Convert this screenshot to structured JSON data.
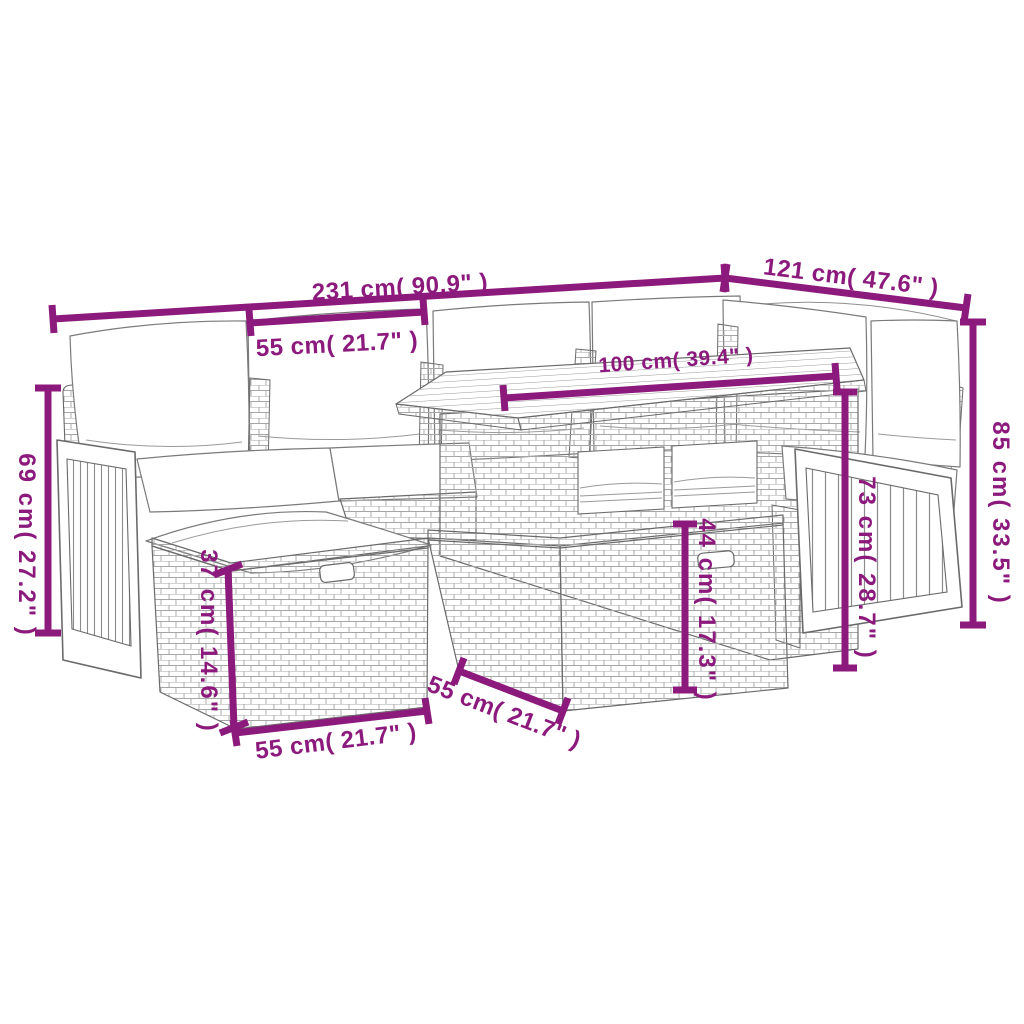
{
  "colors": {
    "dimension": "#8C1A7C",
    "line_art": "#6A6A6A",
    "texture": "#A6A6A6",
    "background": "#FFFFFF"
  },
  "diagram": {
    "type": "furniture-dimension-diagram",
    "subject": "poly rattan garden lounge set with cushions, ottomans and slatted-top table",
    "dimensions": [
      {
        "id": "total-width",
        "label": "231 cm( 90.9\" )",
        "cm": 231,
        "inch": 90.9,
        "orientation": "horizontal"
      },
      {
        "id": "right-side-depth",
        "label": "121 cm( 47.6\" )",
        "cm": 121,
        "inch": 47.6,
        "orientation": "horizontal-angled"
      },
      {
        "id": "seat-cushion-width",
        "label": "55 cm( 21.7\" )",
        "cm": 55,
        "inch": 21.7,
        "orientation": "horizontal"
      },
      {
        "id": "table-top-length",
        "label": "100 cm( 39.4\" )",
        "cm": 100,
        "inch": 39.4,
        "orientation": "horizontal"
      },
      {
        "id": "backrest-height-right",
        "label": "85 cm( 33.5\" )",
        "cm": 85,
        "inch": 33.5,
        "orientation": "vertical"
      },
      {
        "id": "backrest-height-left",
        "label": "69 cm( 27.2\" )",
        "cm": 69,
        "inch": 27.2,
        "orientation": "vertical"
      },
      {
        "id": "table-height",
        "label": "73 cm( 28.7\" )",
        "cm": 73,
        "inch": 28.7,
        "orientation": "vertical"
      },
      {
        "id": "front-seat-height",
        "label": "44 cm( 17.3\" )",
        "cm": 44,
        "inch": 17.3,
        "orientation": "vertical"
      },
      {
        "id": "ottoman-height",
        "label": "37 cm( 14.6\" )",
        "cm": 37,
        "inch": 14.6,
        "orientation": "vertical"
      },
      {
        "id": "ottoman-width",
        "label": "55 cm( 21.7\" )",
        "cm": 55,
        "inch": 21.7,
        "orientation": "horizontal"
      },
      {
        "id": "ottoman-depth",
        "label": "55 cm( 21.7\" )",
        "cm": 55,
        "inch": 21.7,
        "orientation": "horizontal-angled"
      }
    ]
  }
}
